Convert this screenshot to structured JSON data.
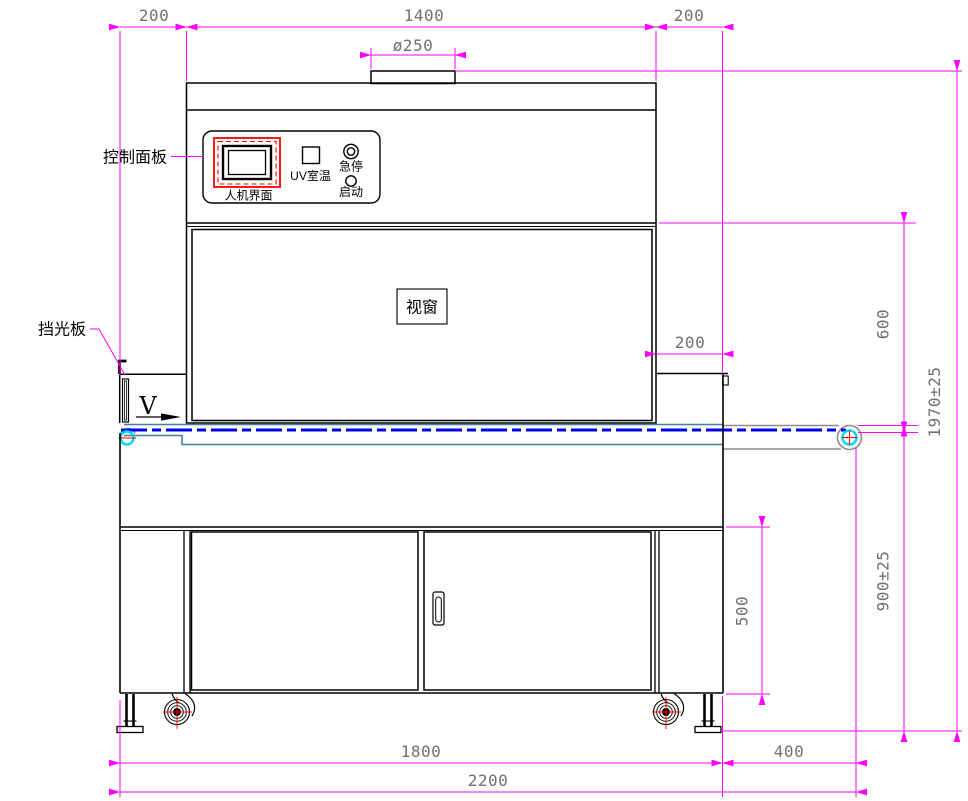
{
  "labels": {
    "control_panel": "控制面板",
    "hmi": "人机界面",
    "uv_temp": "UV室温",
    "estop": "急停",
    "start": "启动",
    "window": "视窗",
    "light_shield": "挡光板",
    "belt_direction": "V"
  },
  "dimensions": {
    "top_left": "200",
    "top_center": "1400",
    "top_right": "200",
    "port_diameter": "ø250",
    "right_offset": "200",
    "lamp_to_belt_height": "600",
    "total_height": "1970±25",
    "belt_height": "900±25",
    "door_height": "500",
    "body_width": "1800",
    "belt_extension": "400",
    "total_width": "2200"
  },
  "colors": {
    "dimension_lines": "#ff00ff",
    "dimension_text": "#707070",
    "outline": "#000000",
    "belt_line": "#0000f0",
    "belt_frame": "#3f7f9f",
    "pulley": "#00d8f0",
    "crosshair": "#ff0000",
    "screen_border": "#ff0000",
    "gray_extension": "#8c8c8c"
  }
}
